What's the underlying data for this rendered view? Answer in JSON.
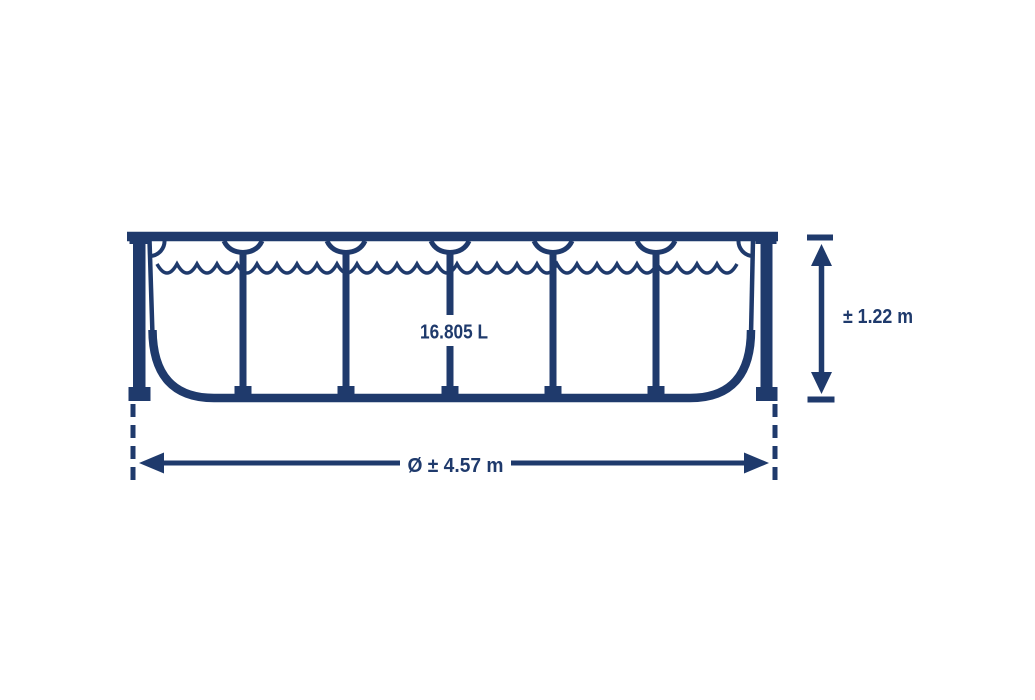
{
  "colors": {
    "line": "#1f3a6c",
    "background": "#ffffff"
  },
  "labels": {
    "capacity": "16.805 L",
    "height": "± 1.22 m",
    "diameter": "Ø ± 4.57 m"
  }
}
